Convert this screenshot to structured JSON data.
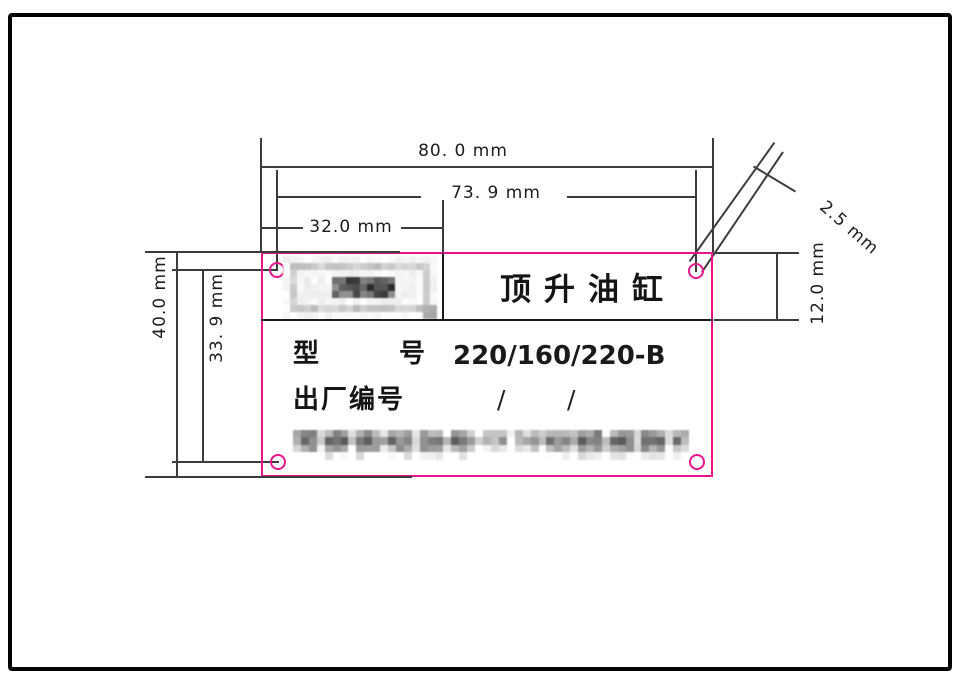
{
  "drawing": {
    "type": "nameplate engineering drawing",
    "nameplate": {
      "title": "顶升油缸",
      "model_label": [
        "型",
        "号"
      ],
      "model_value": "220/160/220-B",
      "serial_label": "出厂编号",
      "serial_slashes": [
        "/",
        "/"
      ],
      "redactions": {
        "logo": "pixelated",
        "manufacturer_line": "pixelated"
      }
    },
    "dimensions": {
      "overall_width": "80. 0 mm",
      "hole_pitch_width": "73. 9 mm",
      "logo_cell_width": "32.0 mm",
      "overall_height": "40.0 mm",
      "hole_pitch_height": "33. 9 mm",
      "title_row_height": "12.0 mm",
      "hole_diameter": "2.5 mm"
    },
    "colors": {
      "plate_outline": "#e8148c",
      "dimension_lines": "#3c3c3c",
      "text": "#151515",
      "background": "#ffffff"
    }
  }
}
